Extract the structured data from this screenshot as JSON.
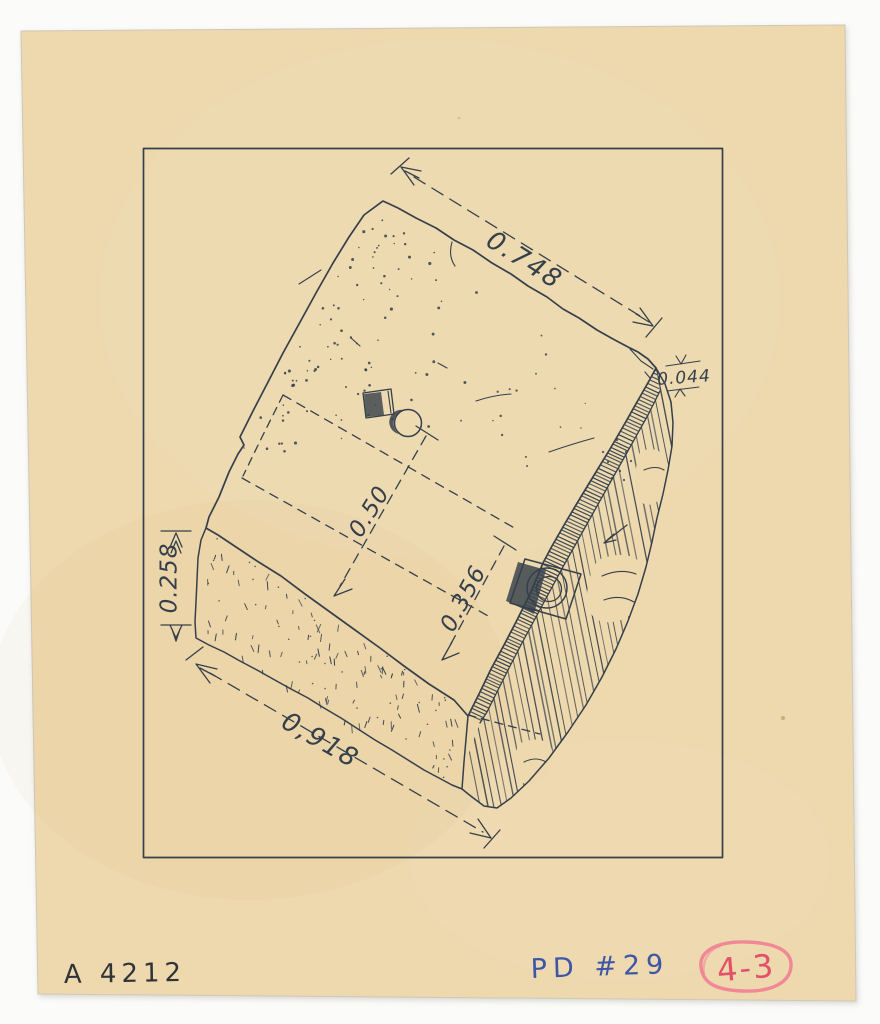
{
  "artifact_drawing": {
    "dimensions": {
      "top_edge": "0.748",
      "corner_chip": "0.044",
      "center_width": "0.50",
      "socket_offset": "0.356",
      "side_height": "0.258",
      "bottom_edge": "0,918"
    },
    "annotations": {
      "inventory_number": "A 4212",
      "plan_reference": "PD #29",
      "grid_reference": "4-3"
    },
    "colors": {
      "paper": "#eed8ad",
      "scan_background": "#fbfbf9",
      "ink": "#35404a",
      "pencil_dark": "#2e3438",
      "blue_ink": "#3d56a5",
      "red_crayon": "#e2506a",
      "red_circle": "#ef8093"
    }
  }
}
